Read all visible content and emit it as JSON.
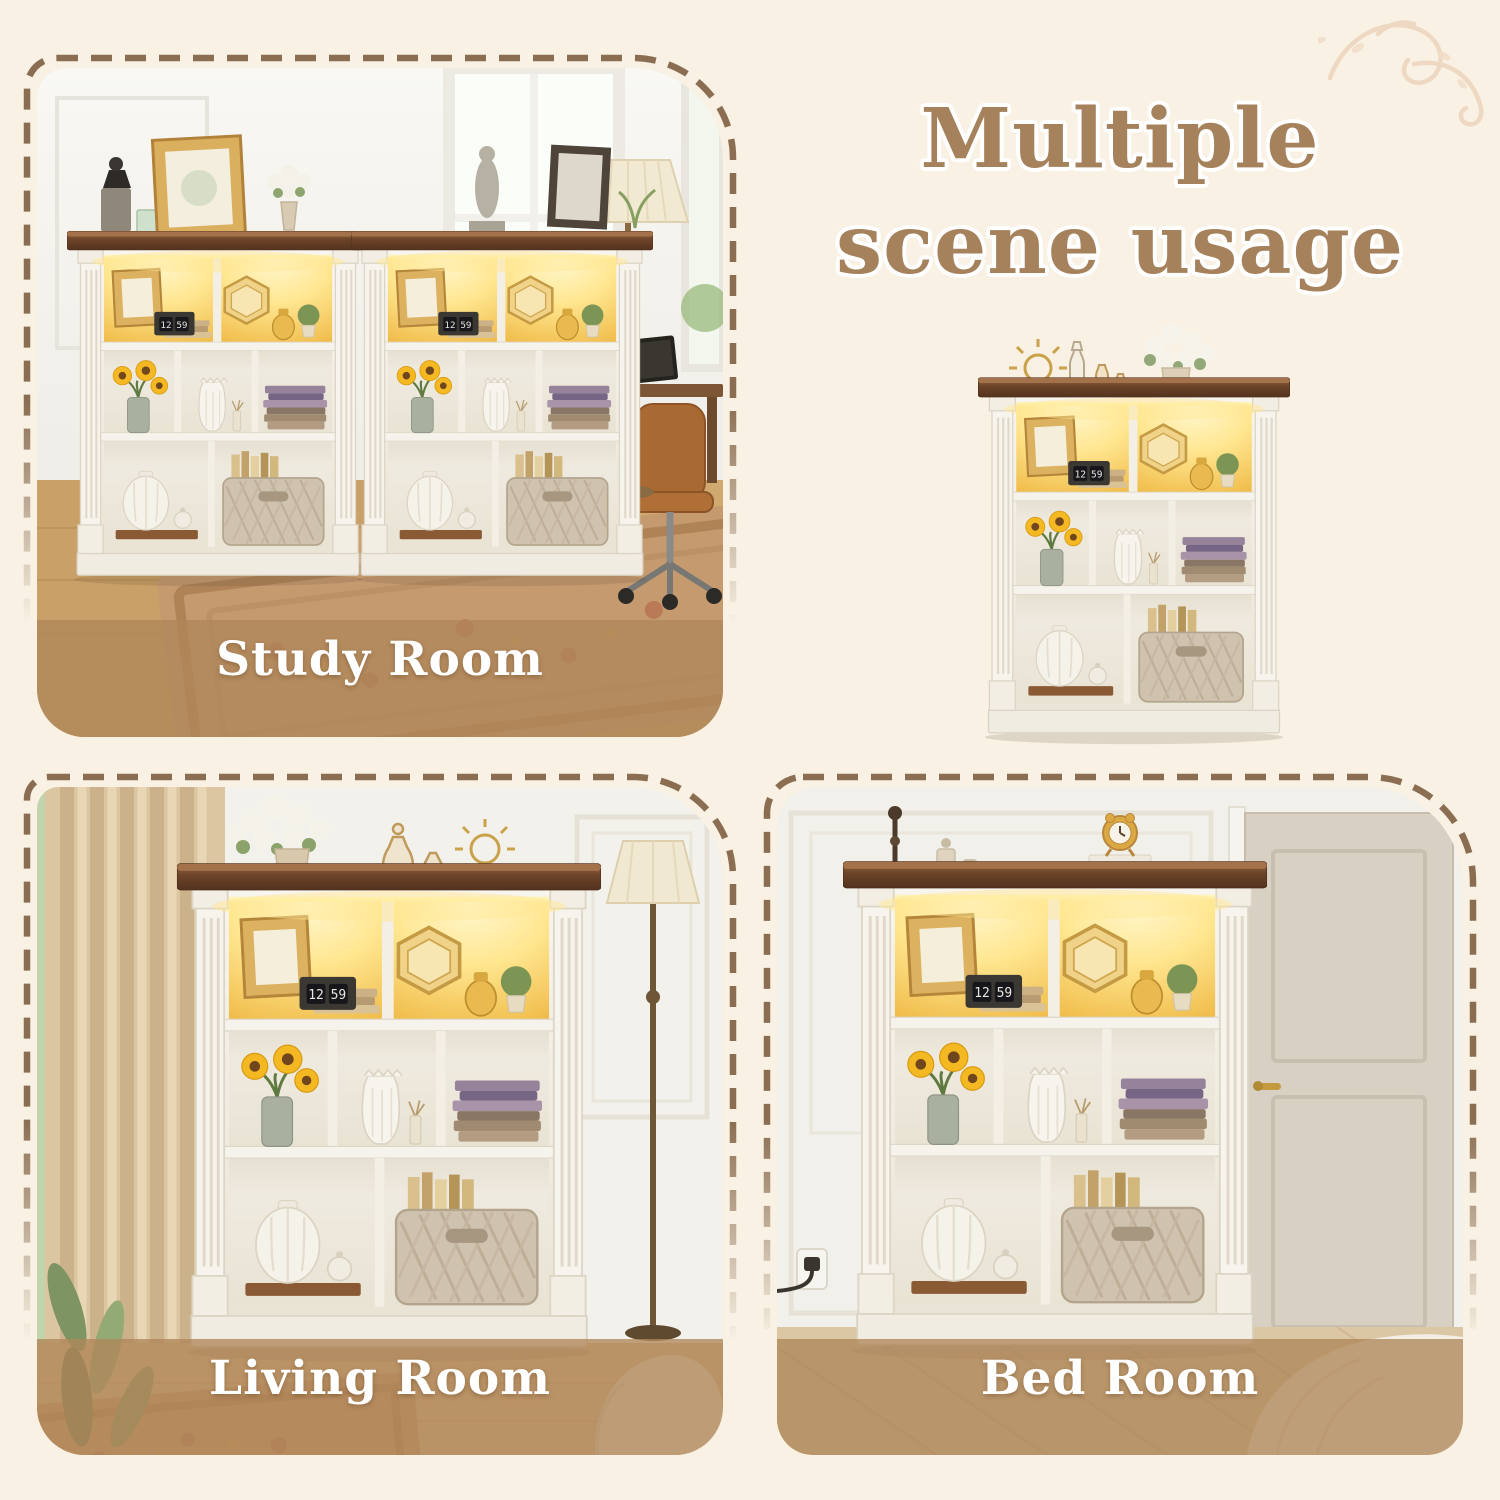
{
  "title": {
    "line1": "Multiple",
    "line2": "scene usage",
    "text_color": "#a5825c",
    "outline_color": "#ffffff"
  },
  "cards": {
    "study": {
      "label": "Study Room"
    },
    "living": {
      "label": "Living Room"
    },
    "bed": {
      "label": "Bed Room"
    }
  },
  "decor": {
    "flourish_icon": "flourish-swirl-icon"
  },
  "styles": {
    "page_background": "#f8f1e4",
    "dash_border_color": "#8b6e52",
    "label_band_color": "rgba(176,135,90,0.78)",
    "label_text_color": "#ffffff",
    "led_glow_color": "#ffe690",
    "wood_top_color": "#6b4328",
    "cabinet_color": "#f4f1ea",
    "flourish_color": "#eed6bf"
  }
}
